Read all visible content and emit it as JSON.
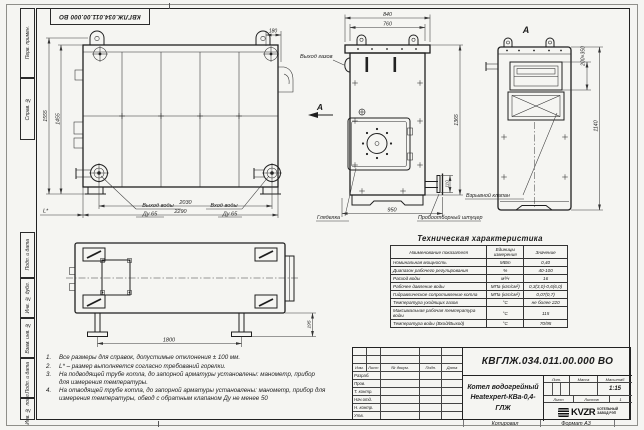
{
  "corner_stamp": "КВГЛЖ.034.011.00.000 ВО",
  "margin_labels": [
    "Перв. примен.",
    "Справ. №",
    "Подп. и дата",
    "Инв. № дубл.",
    "Взам. инв. №",
    "Подп. и дата",
    "Инв. № подл."
  ],
  "views": {
    "front": {
      "dims": {
        "top": "180",
        "height_outer": "1555",
        "height_inner": "1455",
        "width_inner": "2030",
        "width_outer": "2290",
        "l_star": "L*"
      },
      "labels": {
        "outlet_line1": "Выход воды",
        "outlet_line2": "Ду 65",
        "inlet_line1": "Вход воды",
        "inlet_line2": "Ду 65"
      }
    },
    "side": {
      "dims": {
        "width_outer": "840",
        "width_inner": "760",
        "height": "1365",
        "depth": "950",
        "stub": "110"
      },
      "labels": {
        "gas_outlet": "Выход газов",
        "section_mark": "А",
        "sight_glass": "Гляделка",
        "sampling_fitting": "Пробоотборный штуцер"
      }
    },
    "rear": {
      "view_mark": "А",
      "dims": {
        "hatch": "200×350",
        "height": "1140"
      },
      "labels": {
        "explosion_valve": "Взрывной клапан"
      }
    },
    "bottom": {
      "dims": {
        "width": "1800",
        "foot_height": "195"
      }
    }
  },
  "spec_table": {
    "title": "Техническая характеристика",
    "headers": [
      "Наименование показателя",
      "Единицы измерения",
      "Значение"
    ],
    "rows": [
      [
        "Номинальная мощность",
        "МВт",
        "0,40"
      ],
      [
        "Диапазон рабочего регулирования",
        "%",
        "40-100"
      ],
      [
        "Расход воды",
        "м³/ч",
        "16"
      ],
      [
        "Рабочее давление воды",
        "МПа (кгс/см²)",
        "0,3(3,0)-0,6(6,0)"
      ],
      [
        "Гидравлическое сопротивление котла",
        "МПа (кгс/см²)",
        "0,07(0,7)"
      ],
      [
        "Температура уходящих газов",
        "°С",
        "не более 220"
      ],
      [
        "Максимальная рабочая температура воды",
        "°С",
        "115"
      ],
      [
        "Температура воды (Вход/Выход)",
        "°С",
        "70/95"
      ]
    ]
  },
  "notes": [
    {
      "num": "1.",
      "text": "Все размеры для справок, допустимые отклонения ± 100 мм."
    },
    {
      "num": "2.",
      "text": "L* – размер выполняется согласно требований горелки."
    },
    {
      "num": "3.",
      "text": "На подводящей трубе котла, до запорной арматуры установлены: манометр, прибор для измерения температуры."
    },
    {
      "num": "4.",
      "text": "На отводящей трубе котла, до запорной арматуры установлены: манометр, прибор для измерения температуры, обвод с обратным клапаном Ду не менее 50"
    }
  ],
  "title_block": {
    "doc_number": "КВГЛЖ.034.011.00.000 ВО",
    "product_line1": "Котел водогрейный",
    "product_line2": "Heatexpert-КВа-0,4-ГЛЖ",
    "sign_headers": [
      "Изм.",
      "Лист",
      "№ докум.",
      "Подп.",
      "Дата"
    ],
    "sign_rows": [
      "Разраб.",
      "Пров.",
      "Т. контр.",
      "Нач.отд.",
      "Н. контр.",
      "Утв."
    ],
    "lit_label": "Лит.",
    "mass_label": "Масса",
    "scale_label": "Масштаб",
    "scale_value": "1:15",
    "sheet_label": "Лист",
    "sheets_label": "Листов",
    "sheets_value": "1",
    "logo_text": "KVZR",
    "logo_caption1": "КОТЕЛЬНЫЙ",
    "logo_caption2": "ЗАВОД РЭП"
  },
  "footer": {
    "copied": "Копировал",
    "format": "Формат А3"
  },
  "colors": {
    "line": "#1f1f1f",
    "dim": "#3a3a3a",
    "paper": "#f5f5f2"
  }
}
